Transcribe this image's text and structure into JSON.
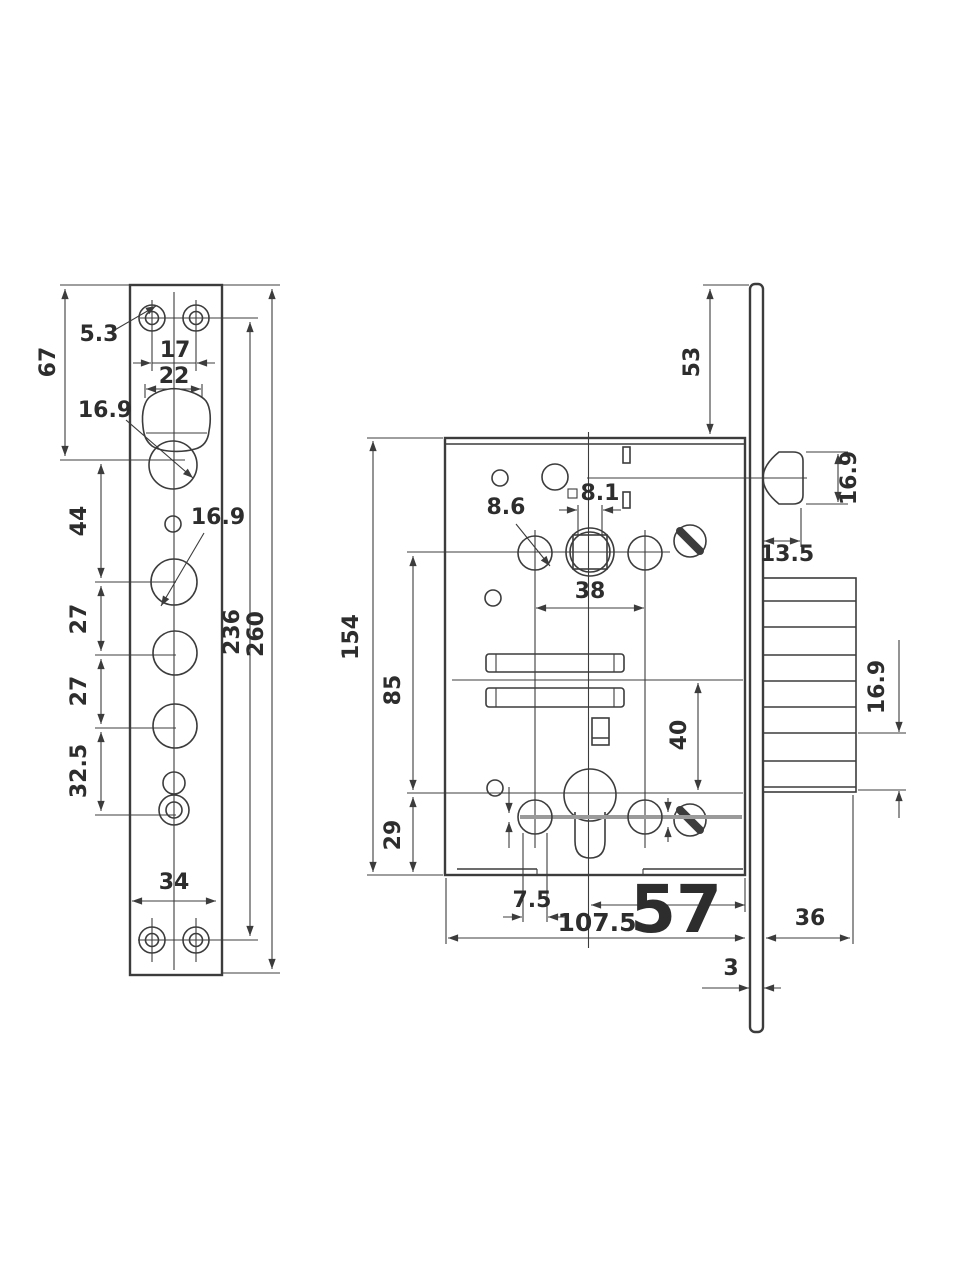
{
  "colors": {
    "accent_red": "#c93227",
    "ink": "#3c3c3c",
    "paper": "#ffffff"
  },
  "front_view": {
    "screw_hole_dia": "5.3",
    "screw_spacing": "17",
    "latch_cutout_width": "22",
    "top_section_height": "67",
    "latch_hole_dia": "16.9",
    "hub_hole_dia": "16.9",
    "latch_to_hub": "44",
    "hub_spacing_1": "27",
    "hub_spacing_2": "27",
    "hub_to_cylinder": "32.5",
    "plate_width": "34",
    "screw_centers_height": "236",
    "plate_height": "260"
  },
  "side_view": {
    "plate_above_case": "53",
    "latch_height": "16.9",
    "latch_depth": "13.5",
    "case_height": "154",
    "hole_dia": "8.6",
    "spindle_square": "8.1",
    "hole_spacing": "38",
    "spindle_to_cylinder": "85",
    "cylinder_to_bottom": "29",
    "slot_to_cylinder": "40",
    "bolt_step": "16.9",
    "offset": "7.5",
    "case_depth": "107.5",
    "backset": "57",
    "bolt_width": "36",
    "plate_thickness": "3"
  }
}
